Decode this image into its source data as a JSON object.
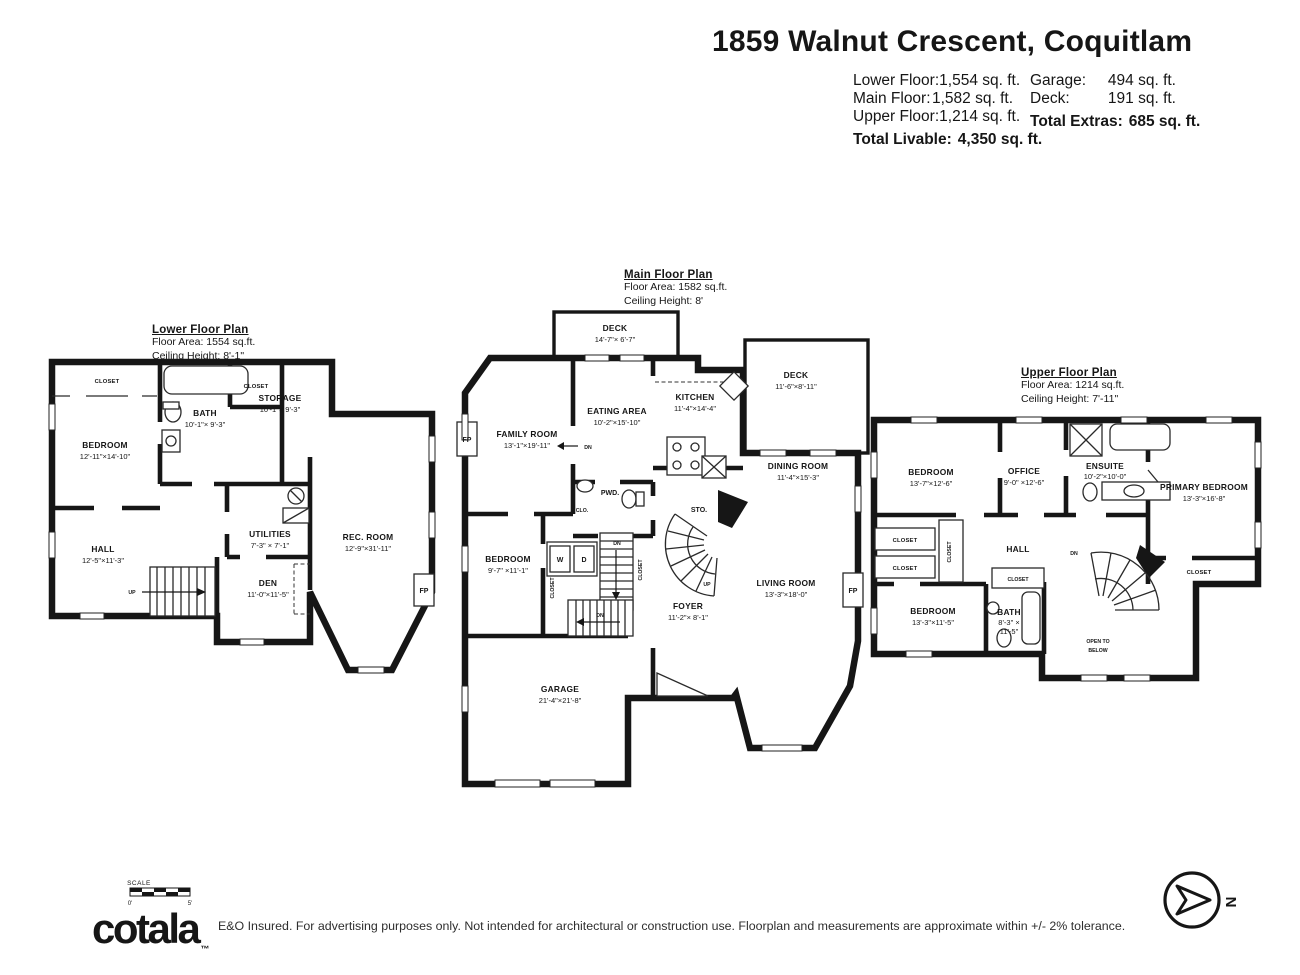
{
  "header": {
    "title": "1859 Walnut Crescent, Coquitlam",
    "stats": {
      "left": [
        {
          "label": "Lower Floor:",
          "value": "1,554 sq. ft."
        },
        {
          "label": "Main Floor:",
          "value": "1,582 sq. ft."
        },
        {
          "label": "Upper Floor:",
          "value": "1,214 sq. ft."
        }
      ],
      "left_total": {
        "label": "Total Livable:",
        "value": "4,350 sq. ft."
      },
      "right": [
        {
          "label": "Garage:",
          "value": "494 sq. ft."
        },
        {
          "label": "Deck:",
          "value": "191 sq. ft."
        }
      ],
      "right_total": {
        "label": "Total Extras:",
        "value": "685 sq. ft."
      }
    }
  },
  "floors": {
    "lower": {
      "title": "Lower Floor Plan",
      "area": "Floor Area: 1554 sq.ft.",
      "ceiling": "Ceiling Height: 8'-1\"",
      "rooms": {
        "bedroom": {
          "name": "BEDROOM",
          "dims": "12'-11\"×14'-10\""
        },
        "bath": {
          "name": "BATH",
          "dims": "10'-1\"× 9'-3\""
        },
        "storage": {
          "name": "STORAGE",
          "dims": "10'-1\"× 9'-3\""
        },
        "hall": {
          "name": "HALL",
          "dims": "12'-5\"×11'-3\""
        },
        "utilities": {
          "name": "UTILITIES",
          "dims": "7'-3\" × 7'-1\""
        },
        "den": {
          "name": "DEN",
          "dims": "11'-0\"×11'-5\""
        },
        "rec_room": {
          "name": "REC. ROOM",
          "dims": "12'-9\"×31'-11\""
        }
      },
      "labels": {
        "closet_bedroom": "CLOSET",
        "closet_bath": "CLOSET",
        "up": "UP",
        "fp": "FP"
      }
    },
    "main": {
      "title": "Main Floor Plan",
      "area": "Floor Area: 1582 sq.ft.",
      "ceiling": "Ceiling Height: 8'",
      "rooms": {
        "deck_top": {
          "name": "DECK",
          "dims": "14'-7\"× 6'-7\""
        },
        "deck_right": {
          "name": "DECK",
          "dims": "11'-6\"×8'-11\""
        },
        "family": {
          "name": "FAMILY ROOM",
          "dims": "13'-1\"×19'-11\""
        },
        "eating": {
          "name": "EATING AREA",
          "dims": "10'-2\"×15'-10\""
        },
        "kitchen": {
          "name": "KITCHEN",
          "dims": "11'-4\"×14'-4\""
        },
        "dining": {
          "name": "DINING ROOM",
          "dims": "11'-4\"×15'-3\""
        },
        "living": {
          "name": "LIVING ROOM",
          "dims": "13'-3\"×18'-0\""
        },
        "bedroom": {
          "name": "BEDROOM",
          "dims": "9'-7\" ×11'-1\""
        },
        "foyer": {
          "name": "FOYER",
          "dims": "11'-2\"× 8'-1\""
        },
        "garage": {
          "name": "GARAGE",
          "dims": "21'-4\"×21'-8\""
        },
        "pwd": {
          "name": "PWD."
        },
        "sto": {
          "name": "STO."
        }
      },
      "labels": {
        "w": "W",
        "d": "D",
        "clo": "CLO.",
        "closet_left": "CLOSET",
        "closet_right": "CLOSET",
        "dn1": "DN",
        "dn2": "DN",
        "dn3": "DN",
        "up": "UP",
        "fp_left": "FP",
        "fp_right": "FP"
      }
    },
    "upper": {
      "title": "Upper Floor Plan",
      "area": "Floor Area: 1214 sq.ft.",
      "ceiling": "Ceiling Height: 7'-11\"",
      "rooms": {
        "bedroom_left": {
          "name": "BEDROOM",
          "dims": "13'-7\"×12'-6\""
        },
        "office": {
          "name": "OFFICE",
          "dims": "9'-0\" ×12'-6\""
        },
        "ensuite": {
          "name": "ENSUITE",
          "dims": "10'-2\"×10'-0\""
        },
        "primary": {
          "name": "PRIMARY BEDROOM",
          "dims": "13'-3\"×16'-8\""
        },
        "bedroom_bottom": {
          "name": "BEDROOM",
          "dims": "13'-3\"×11'-5\""
        },
        "bath": {
          "name": "BATH",
          "dims_line1": "8'-3\" ×",
          "dims_line2": "11'-5\""
        },
        "hall": {
          "name": "HALL"
        },
        "open_below_line1": "OPEN TO",
        "open_below_line2": "BELOW"
      },
      "labels": {
        "closet1": "CLOSET",
        "closet2": "CLOSET",
        "closet_v": "CLOSET",
        "closet_small": "CLOSET",
        "closet_primary": "CLOSET",
        "dn": "DN"
      }
    }
  },
  "footer": {
    "scale_label": "SCALE",
    "scale_start": "0'",
    "scale_end": "5'",
    "logo": "cotala",
    "logo_tm": "™",
    "disclaimer": "E&O Insured. For advertising purposes only. Not intended for architectural or construction use. Floorplan and measurements are approximate within +/- 2% tolerance.",
    "compass_letter": "N"
  }
}
